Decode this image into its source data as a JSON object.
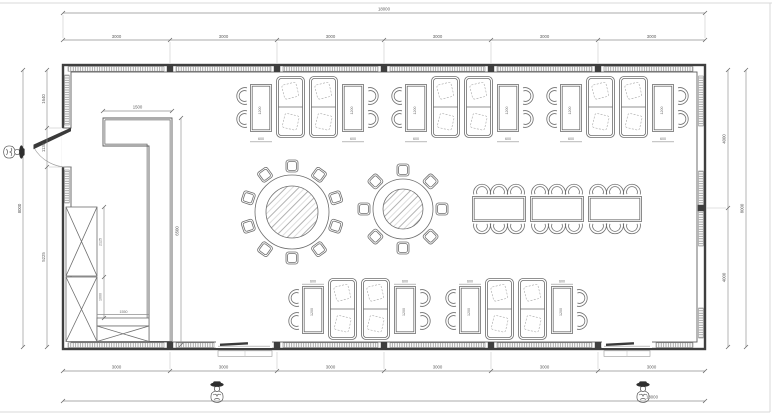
{
  "meta": {
    "title": "Dining hall furniture floor plan"
  },
  "dims": {
    "overall_w": "18000",
    "overall_h": "8000",
    "top": [
      "3000",
      "3000",
      "3000",
      "3000",
      "3000",
      "3000"
    ],
    "bottom": [
      "3000",
      "3000",
      "3000",
      "3000",
      "3000",
      "3000"
    ],
    "left": [
      "1640",
      "1135",
      "5225"
    ],
    "right": [
      "4000",
      "4000"
    ],
    "counter_w": "1500",
    "counter_h": "6500",
    "cabinet_upper_h": "2125",
    "cabinet_lower_h": "1000",
    "cabinet_w": "1550",
    "table_w": "600",
    "table_l": "1200"
  },
  "contents": {
    "booth_groups_top": 3,
    "booth_groups_bottom": 2,
    "round_table_large_seats": 10,
    "round_table_small_seats": 8,
    "banquet_tables": 3,
    "banquet_seats": 18,
    "wardrobe_units": 3,
    "entrances": 3,
    "person_figures": 3
  }
}
